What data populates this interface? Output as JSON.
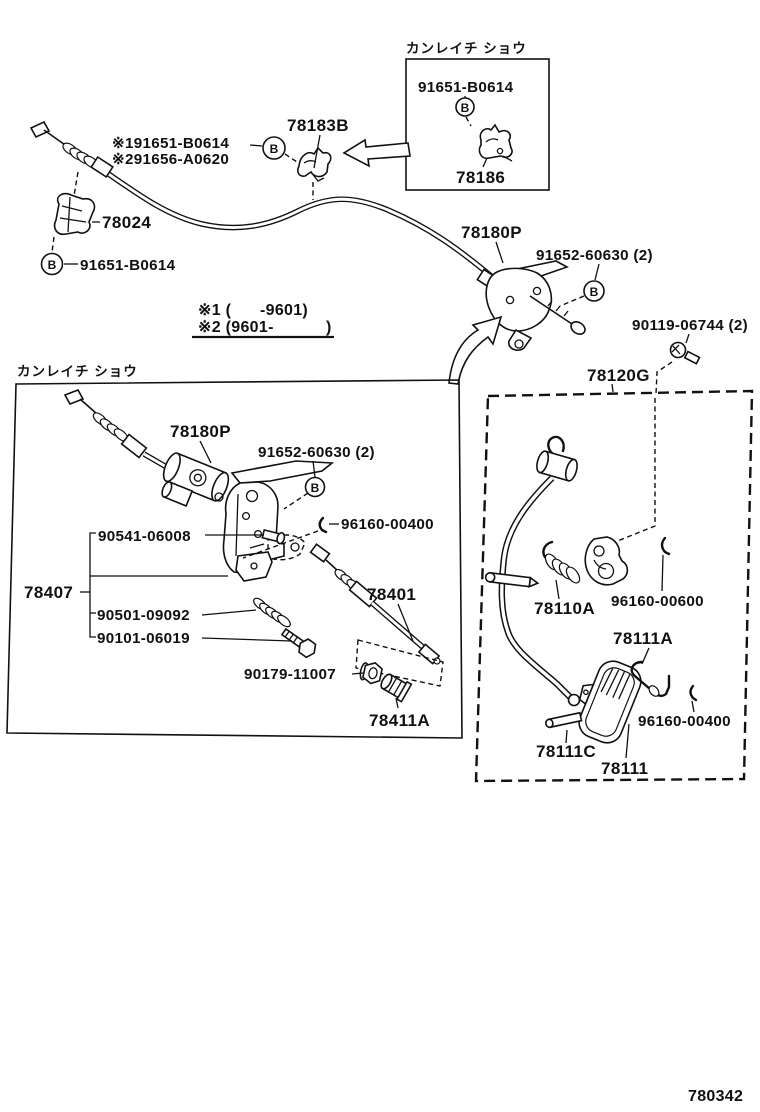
{
  "page_code": "780342",
  "marker_letter": "B",
  "main": {
    "clamp_label": "78183B",
    "alt_bolt_label_1": "※191651-B0614",
    "alt_bolt_label_2": "※291656-A0620",
    "clip_label": "78024",
    "bolt_label": "91651-B0614",
    "link_label": "78180P",
    "screw_label": "91652-60630 (2)",
    "note_1_open": "※1 (",
    "note_1_close": "-9601)",
    "note_2_open": "※2 (9601-",
    "note_2_close": ")",
    "pedal_bolt_label": "90119-06744 (2)",
    "pedal_assy_label": "78120G"
  },
  "inset_top_right": {
    "title": "カンレイチ ショウ",
    "bolt_label": "91651-B0614",
    "bracket_label": "78186"
  },
  "inset_cold_spec": {
    "title": "カンレイチ ショウ",
    "link_label": "78180P",
    "screw_label": "91652-60630 (2)",
    "pin_label": "90541-06008",
    "clip_label": "96160-00400",
    "bracket_label": "78407",
    "spring_label": "90501-09092",
    "bolt_label": "90101-06019",
    "nut_label": "90179-11007",
    "bush_label": "78411A",
    "rod_label": "78401"
  },
  "pedal_box": {
    "spring_label": "78110A",
    "clip_label": "96160-00600",
    "pad_spring_label": "78111A",
    "pad_clip_label": "96160-00400",
    "pad_pin_label": "78111C",
    "pad_label": "78111"
  }
}
